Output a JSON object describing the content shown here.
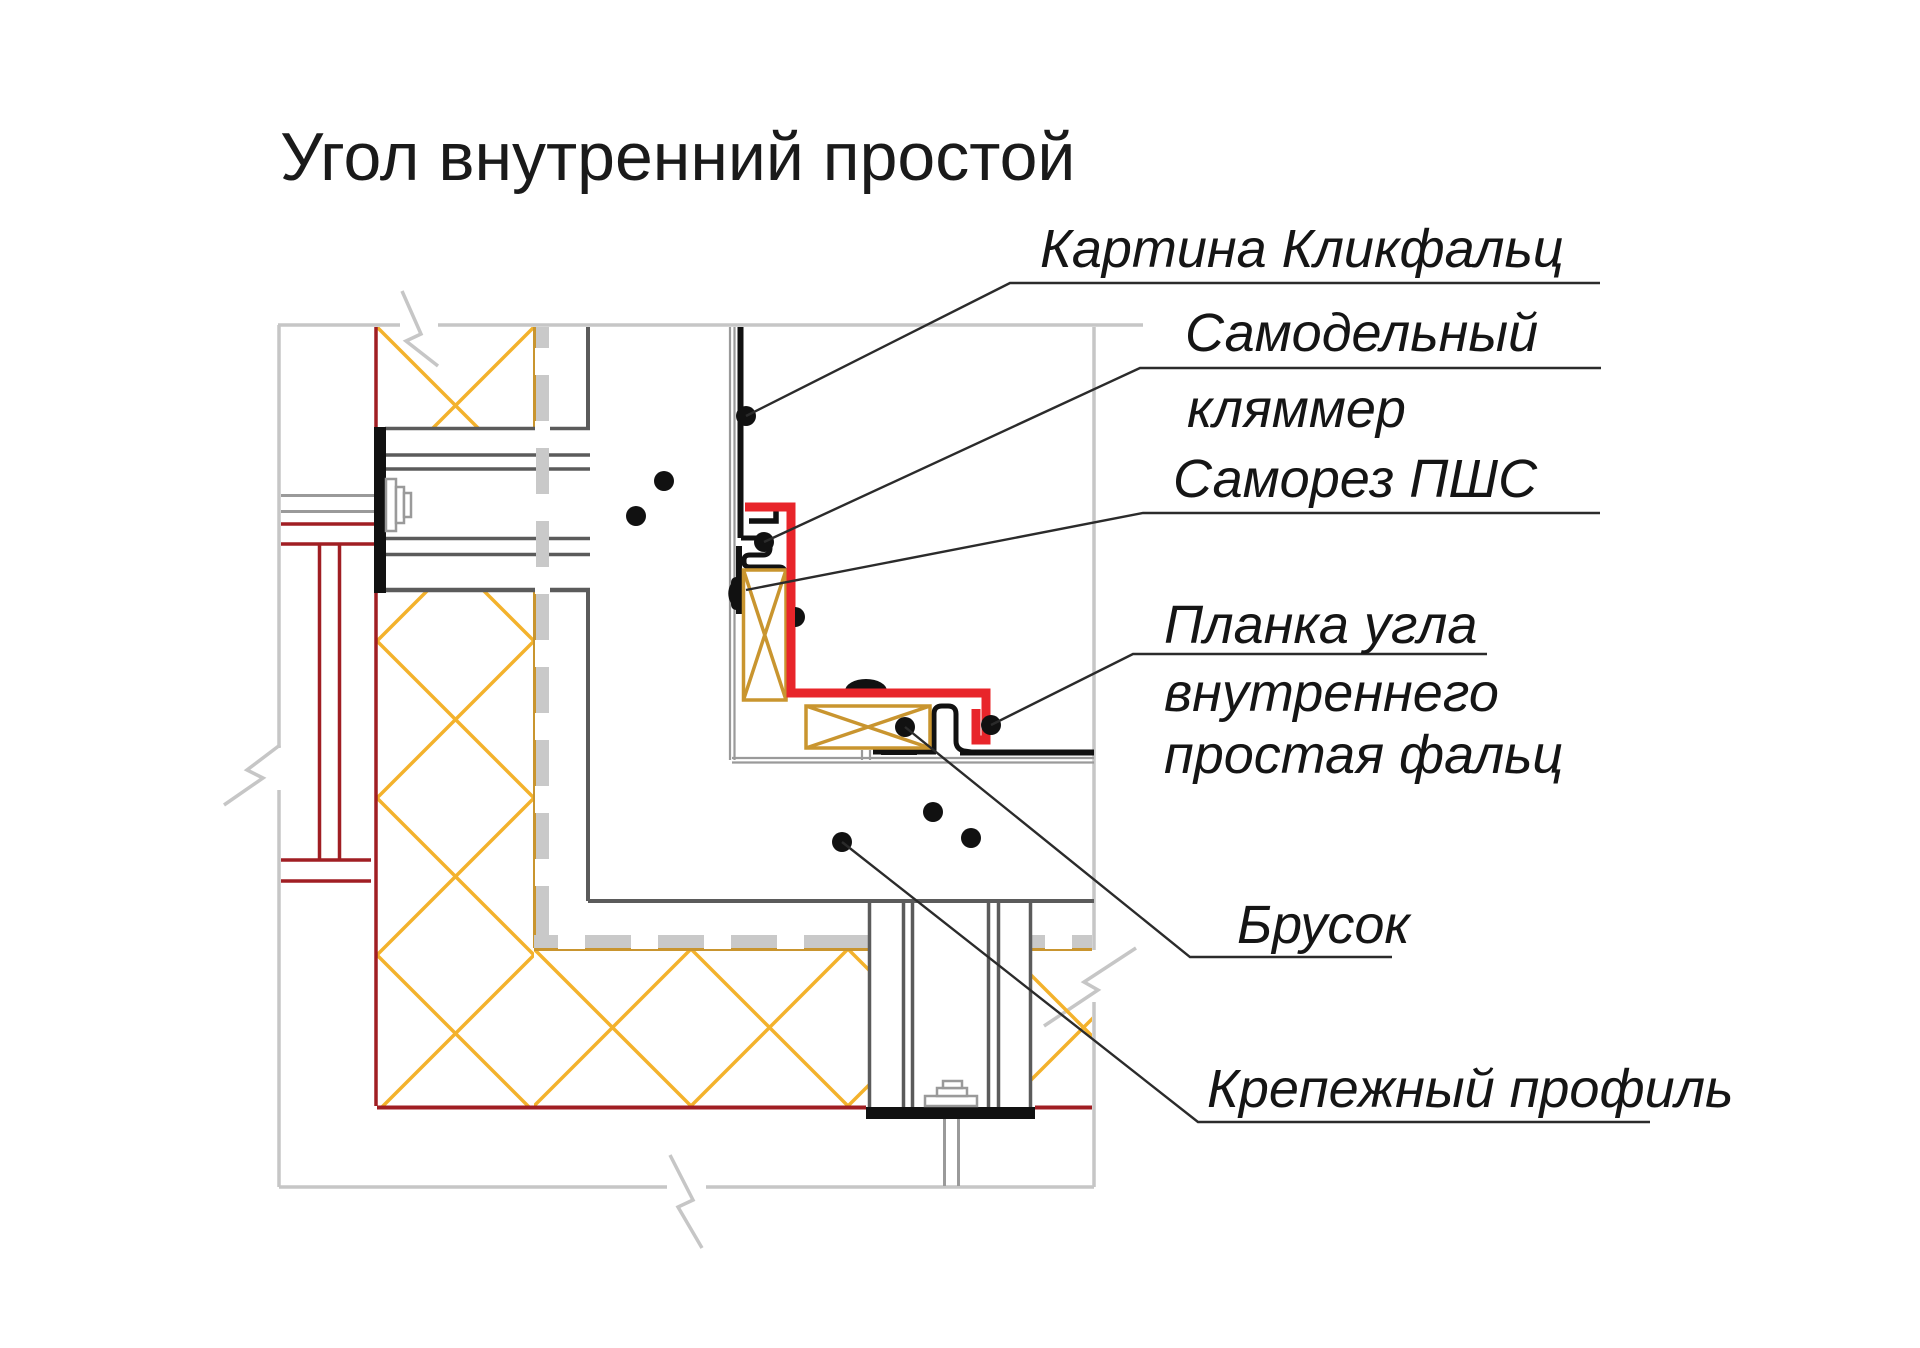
{
  "title": "Угол внутренний простой",
  "labels": {
    "panel": "Картина Кликфальц",
    "clip_line1": "Самодельный",
    "clip_line2": "кляммер",
    "screw": "Саморез ПШС",
    "corner_strip_line1": "Планка угла",
    "corner_strip_line2": "внутреннего",
    "corner_strip_line3": "простая фальц",
    "block": "Брусок",
    "profile": "Крепежный профиль"
  },
  "colors": {
    "flashing_red": "#e8252a",
    "structure_dark_red": "#a01e23",
    "insulation_yellow": "#f3b22c",
    "wood_tan": "#c9952f",
    "boundary_light_gray": "#c6c6c6",
    "subframe_gray": "#9a9a9a",
    "wall_face_gray": "#5b5b5b",
    "metal_black": "#111111"
  }
}
